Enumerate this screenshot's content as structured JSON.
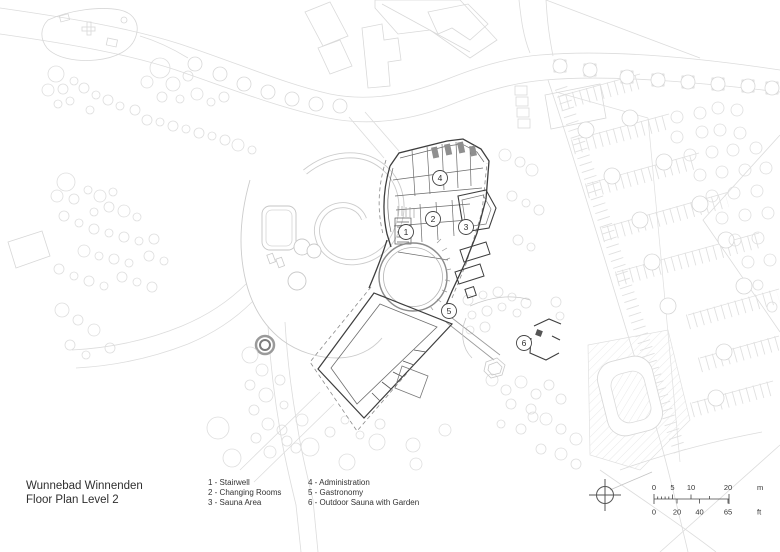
{
  "title": {
    "line1": "Wunnebad Winnenden",
    "line2": "Floor Plan Level 2"
  },
  "legend": {
    "items": [
      {
        "number": "1",
        "label": "Stairwell",
        "text": "1 - Stairwell"
      },
      {
        "number": "2",
        "label": "Changing Rooms",
        "text": "2 - Changing Rooms"
      },
      {
        "number": "3",
        "label": "Sauna Area",
        "text": "3 - Sauna Area"
      },
      {
        "number": "4",
        "label": "Administration",
        "text": "4 - Administration"
      },
      {
        "number": "5",
        "label": "Gastronomy",
        "text": "5 - Gastronomy"
      },
      {
        "number": "6",
        "label": "Outdoor Sauna with Garden",
        "text": "6 - Outdoor Sauna with Garden"
      }
    ]
  },
  "plan": {
    "markers": [
      {
        "number": "1"
      },
      {
        "number": "2"
      },
      {
        "number": "3"
      },
      {
        "number": "4"
      },
      {
        "number": "5"
      },
      {
        "number": "6"
      }
    ]
  },
  "scalebar": {
    "m": {
      "ticks": [
        "0",
        "5",
        "10",
        "20"
      ],
      "unit": "m"
    },
    "ft": {
      "ticks": [
        "0",
        "20",
        "40",
        "65"
      ],
      "unit": "ft"
    }
  },
  "colors": {
    "background": "#ffffff",
    "context_light": "#dcdcdc",
    "context_mid": "#c6c6c6",
    "building_dark": "#3e3e3e",
    "text": "#333333"
  }
}
